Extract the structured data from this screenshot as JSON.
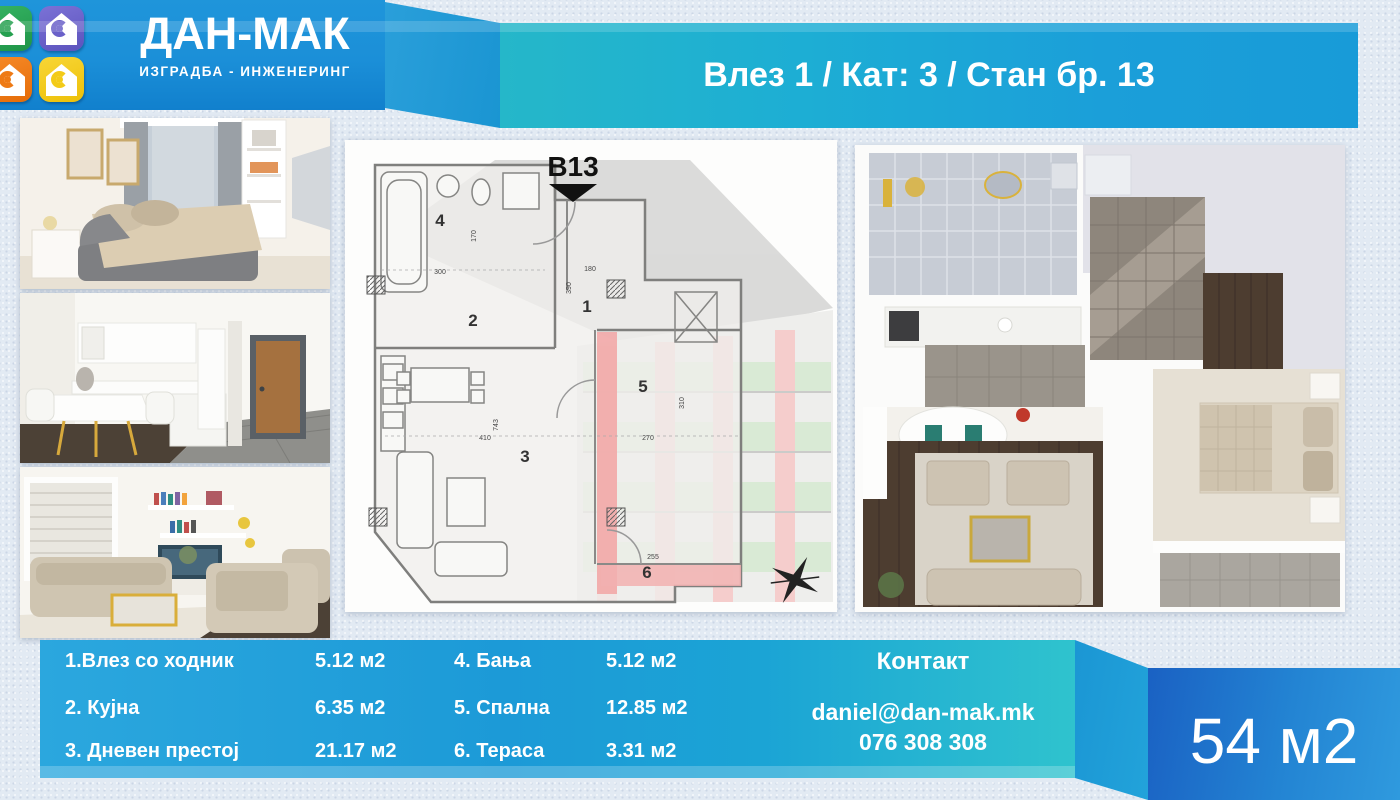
{
  "header": {
    "brand_name": "ДАН-МАК",
    "brand_tagline": "ИЗГРАДБА - ИНЖЕНЕРИНГ",
    "banner_title": "Влез 1 / Кат: 3 / Стан бр. 13",
    "logo_tile_colors": {
      "green": "#25a050",
      "purple": "#6a61c9",
      "orange": "#ee7a15",
      "yellow": "#f3cb18"
    }
  },
  "floor_plan": {
    "unit_label": "B13",
    "room_numbers": [
      "1",
      "2",
      "3",
      "4",
      "5",
      "6"
    ],
    "dimensions": [
      "300",
      "170",
      "180",
      "390",
      "743",
      "410",
      "270",
      "310",
      "255"
    ]
  },
  "rooms": {
    "left_rows": [
      {
        "label": "1.Влез со ходник",
        "area": "5.12 м2"
      },
      {
        "label": "2. Кујна",
        "area": "6.35 м2"
      },
      {
        "label": "3. Дневен престој",
        "area": "21.17 м2"
      }
    ],
    "right_rows": [
      {
        "label": "4. Бања",
        "area": "5.12 м2"
      },
      {
        "label": "5. Спална",
        "area": "12.85 м2"
      },
      {
        "label": "6. Тераса",
        "area": "3.31 м2"
      }
    ]
  },
  "contact": {
    "heading": "Контакт",
    "email": "daniel@dan-mak.mk",
    "phone": "076 308 308"
  },
  "total_area": "54 м2",
  "colors": {
    "banner_teal": "#25b7c9",
    "banner_blue": "#189bd8",
    "logo_panel_blue": "#1b8fd8",
    "band_blue": "#2ba7de",
    "band_teal": "#2fc3ce",
    "area_panel_dark_blue": "#1a61c3",
    "area_panel_light_blue": "#2f9ade",
    "plan_highlight_pink": "#f2a5a5",
    "building_window_green": "#b7d9b0"
  }
}
